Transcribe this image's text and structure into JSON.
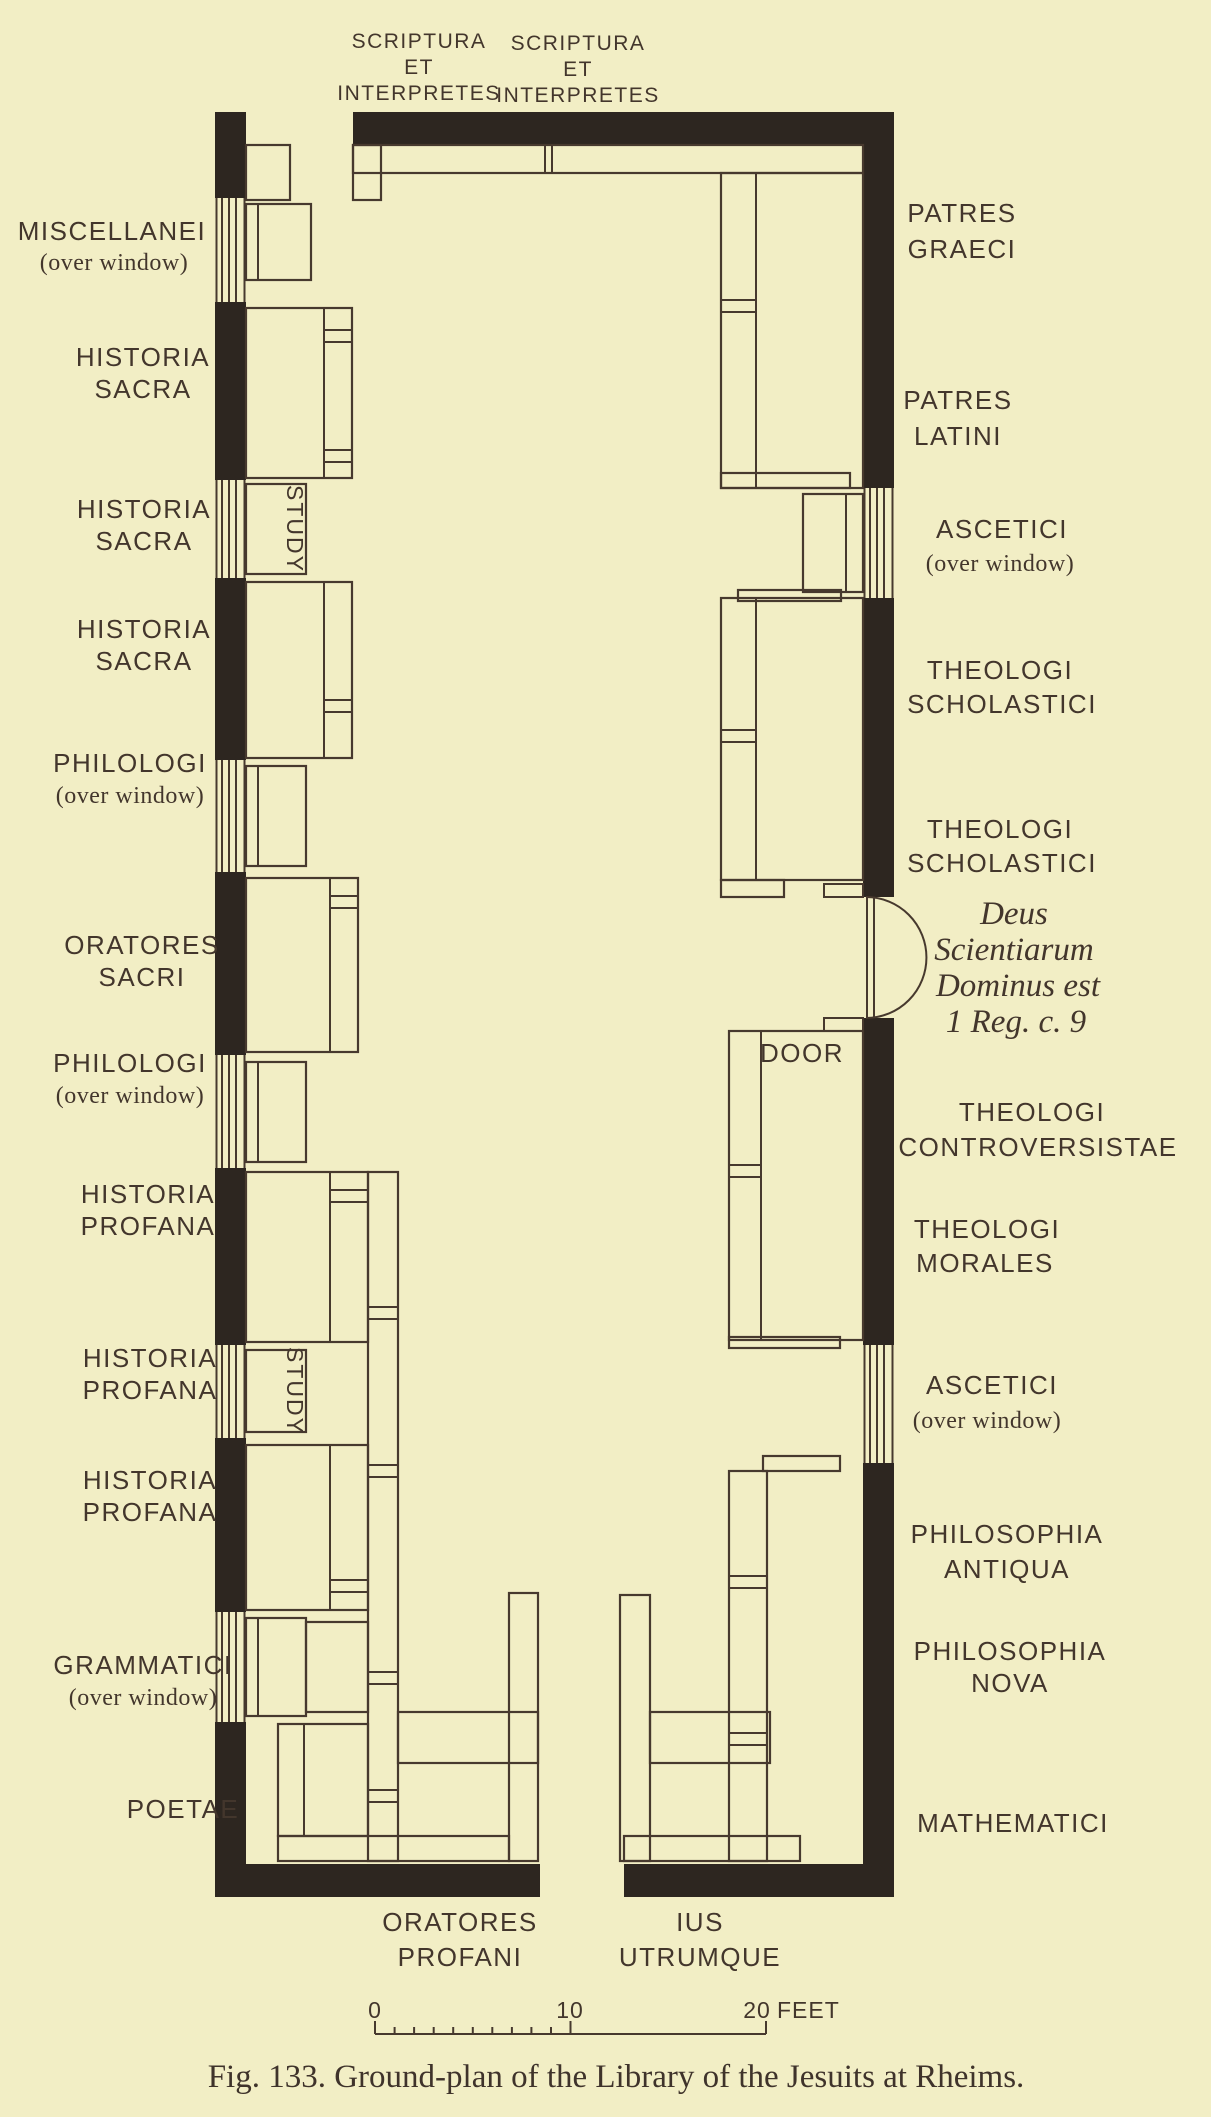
{
  "plan": {
    "top_labels": [
      [
        "SCRIPTURA",
        "ET",
        "INTERPRETES"
      ],
      [
        "SCRIPTURA",
        "ET",
        "INTERPRETES"
      ]
    ],
    "left_labels": [
      [
        "MISCELLANEI",
        "(over window)"
      ],
      [
        "HISTORIA",
        "SACRA"
      ],
      [
        "HISTORIA",
        "SACRA"
      ],
      [
        "HISTORIA",
        "SACRA"
      ],
      [
        "PHILOLOGI",
        "(over window)"
      ],
      [
        "ORATORES",
        "SACRI"
      ],
      [
        "PHILOLOGI",
        "(over window)"
      ],
      [
        "HISTORIA",
        "PROFANA"
      ],
      [
        "HISTORIA",
        "PROFANA"
      ],
      [
        "HISTORIA",
        "PROFANA"
      ],
      [
        "GRAMMATICI",
        "(over window)"
      ],
      [
        "POETAE"
      ]
    ],
    "right_labels": [
      [
        "PATRES",
        "GRAECI"
      ],
      [
        "PATRES",
        "LATINI"
      ],
      [
        "ASCETICI",
        "(over window)"
      ],
      [
        "THEOLOGI",
        "SCHOLASTICI"
      ],
      [
        "THEOLOGI",
        "SCHOLASTICI"
      ],
      [
        "THEOLOGI",
        "CONTROVERSISTAE"
      ],
      [
        "THEOLOGI",
        "MORALES"
      ],
      [
        "ASCETICI",
        "(over window)"
      ],
      [
        "PHILOSOPHIA",
        "ANTIQUA"
      ],
      [
        "PHILOSOPHIA",
        "NOVA"
      ],
      [
        "MATHEMATICI"
      ]
    ],
    "bottom_labels": [
      [
        "ORATORES",
        "PROFANI"
      ],
      [
        "IUS",
        "UTRUMQUE"
      ]
    ],
    "study_label": "STUDY",
    "door_label": "DOOR",
    "door_inscription": [
      "Deus",
      "Scientiarum",
      "Dominus est",
      "1 Reg. c. 9"
    ]
  },
  "scale_bar": {
    "start": "0",
    "mid": "10",
    "end": "20",
    "unit": "FEET"
  },
  "caption": "Fig. 133. Ground-plan of the Library of the Jesuits at Rheims.",
  "colors": {
    "background": "#f2eec5",
    "wall_ink": "#2d2620",
    "line_ink": "#47392e",
    "text_ink": "#43362c"
  }
}
